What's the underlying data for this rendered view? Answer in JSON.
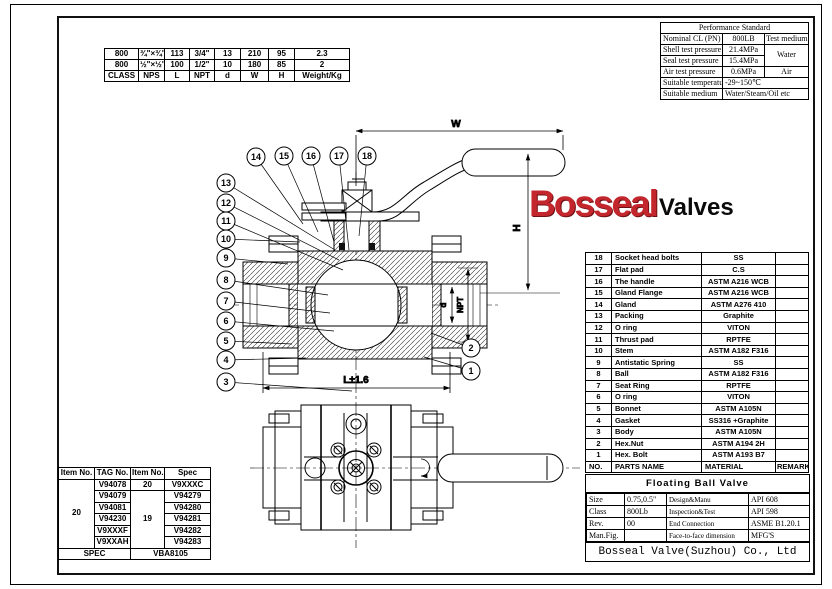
{
  "logo": {
    "primary": "Bosseal",
    "secondary": "Valves",
    "primary_color": "#C3262C"
  },
  "dim_table": {
    "rows": [
      [
        "800",
        "¾\"×¾\"",
        "113",
        "3/4\"",
        "13",
        "210",
        "95",
        "2.3"
      ],
      [
        "800",
        "½\"×½\"",
        "100",
        "1/2\"",
        "10",
        "180",
        "85",
        "2"
      ]
    ],
    "footer": [
      "CLASS",
      "NPS",
      "L",
      "NPT",
      "d",
      "W",
      "H",
      "Weight/Kg"
    ]
  },
  "performance": {
    "title": "Performance Standard",
    "nominal_label": "Nominal CL (PN)",
    "nominal_value": "800LB",
    "test_medium_label": "Test medium",
    "shell_label": "Shell test pressure",
    "shell_value": "21.4MPa",
    "water_value": "Water",
    "seal_label": "Seal test pressure",
    "seal_value": "15.4MPa",
    "air_label": "Air test pressure",
    "air_value": "0.6MPa",
    "air_medium": "Air",
    "temp_label": "Suitable temperature",
    "temp_value": "-29~150℃",
    "medium_label": "Suitable medium",
    "medium_value": "Water/Steam/Oil etc"
  },
  "parts_list": {
    "footer": [
      "NO.",
      "PARTS NAME",
      "MATERIAL",
      "REMARK"
    ],
    "items": [
      {
        "no": "18",
        "name": "Socket head bolts",
        "material": "SS"
      },
      {
        "no": "17",
        "name": "Flat pad",
        "material": "C.S"
      },
      {
        "no": "16",
        "name": "The handle",
        "material": "ASTM A216 WCB"
      },
      {
        "no": "15",
        "name": "Gland Flange",
        "material": "ASTM A216 WCB"
      },
      {
        "no": "14",
        "name": "Gland",
        "material": "ASTM A276 410"
      },
      {
        "no": "13",
        "name": "Packing",
        "material": "Graphite"
      },
      {
        "no": "12",
        "name": "O ring",
        "material": "VITON"
      },
      {
        "no": "11",
        "name": "Thrust pad",
        "material": "RPTFE"
      },
      {
        "no": "10",
        "name": "Stem",
        "material": "ASTM A182 F316"
      },
      {
        "no": "9",
        "name": "Antistatic Spring",
        "material": "SS"
      },
      {
        "no": "8",
        "name": "Ball",
        "material": "ASTM A182 F316"
      },
      {
        "no": "7",
        "name": "Seat Ring",
        "material": "RPTFE"
      },
      {
        "no": "6",
        "name": "O ring",
        "material": "VITON"
      },
      {
        "no": "5",
        "name": "Bonnet",
        "material": "ASTM A105N"
      },
      {
        "no": "4",
        "name": "Gasket",
        "material": "SS316 +Graphite"
      },
      {
        "no": "3",
        "name": "Body",
        "material": "ASTM A105N"
      },
      {
        "no": "2",
        "name": "Hex.Nut",
        "material": "ASTM A194 2H"
      },
      {
        "no": "1",
        "name": "Hex. Bolt",
        "material": "ASTM A193 B7"
      }
    ]
  },
  "tag_table": {
    "headers": [
      "Item No.",
      "TAG No.",
      "Item No.",
      "Spec"
    ],
    "left_item_no": "20",
    "rows": [
      {
        "tag": "V94078",
        "item": "20",
        "spec": "V9XXXC"
      },
      {
        "tag": "V94079",
        "item": "19",
        "spec": "V94279"
      },
      {
        "tag": "V94081",
        "spec": "V94280"
      },
      {
        "tag": "V94230",
        "spec": "V94281"
      },
      {
        "tag": "V9XXXF",
        "spec": "V94282"
      },
      {
        "tag": "V9XXAH",
        "spec": "V94283"
      }
    ],
    "footer_label": "SPEC",
    "footer_value": "VBA8105"
  },
  "title_block": {
    "title": "Floating Ball Valve",
    "rows": [
      {
        "l1": "Size",
        "v1": "0.75,0.5\"",
        "l2": "Design&Manu",
        "v2": "API 608"
      },
      {
        "l1": "Class",
        "v1": "800Lb",
        "l2": "Inspection&Test",
        "v2": "API 598"
      },
      {
        "l1": "Rev.",
        "v1": "00",
        "l2": "End Connection",
        "v2": "ASME B1.20.1"
      },
      {
        "l1": "Man.Fig.",
        "v1": "",
        "l2": "Face-to-face dimension",
        "v2": "MFG'S"
      }
    ],
    "company": "Bosseal Valve(Suzhou) Co., Ltd"
  },
  "drawing": {
    "labels": {
      "w": "W",
      "h": "H",
      "d": "d",
      "npt": "NPT",
      "l": "L±1.6"
    },
    "balloon_numbers": [
      "14",
      "15",
      "16",
      "17",
      "18",
      "13",
      "12",
      "11",
      "10",
      "9",
      "8",
      "7",
      "6",
      "5",
      "4",
      "3",
      "2",
      "1"
    ]
  }
}
